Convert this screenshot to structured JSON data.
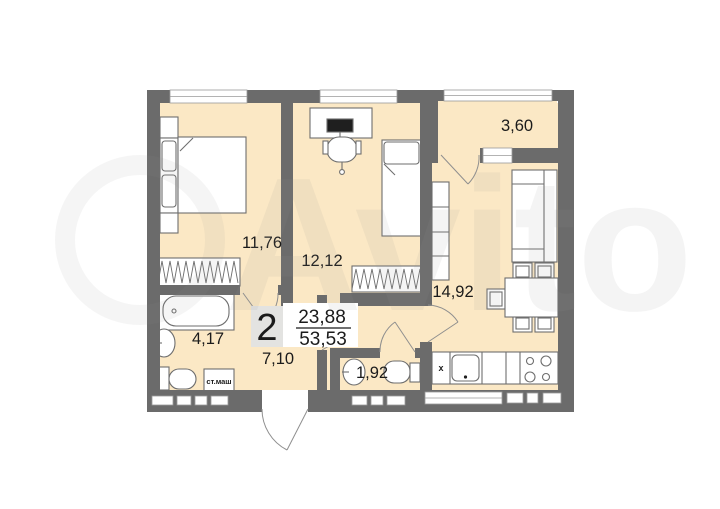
{
  "watermark": {
    "brand": "Avito"
  },
  "apartment": {
    "rooms_count": "2",
    "living_area": "23,88",
    "total_area": "53,53"
  },
  "rooms": {
    "bedroom1": {
      "area": "11,76"
    },
    "bedroom2": {
      "area": "12,12"
    },
    "kitchen": {
      "area": "14,92"
    },
    "balcony": {
      "area": "3,60"
    },
    "bathroom": {
      "area": "4,17"
    },
    "hallway": {
      "area": "7,10"
    },
    "wc": {
      "area": "1,92"
    }
  },
  "annotations": {
    "washing_machine": "ст.маш",
    "kitchen_sink_mark": "x"
  },
  "colors": {
    "floor": "#fbe8c5",
    "wall": "#6b6b6b",
    "furniture_stroke": "#6e6e6e",
    "label_text": "#1b1b1b",
    "watermark": "#8f8f8f"
  }
}
